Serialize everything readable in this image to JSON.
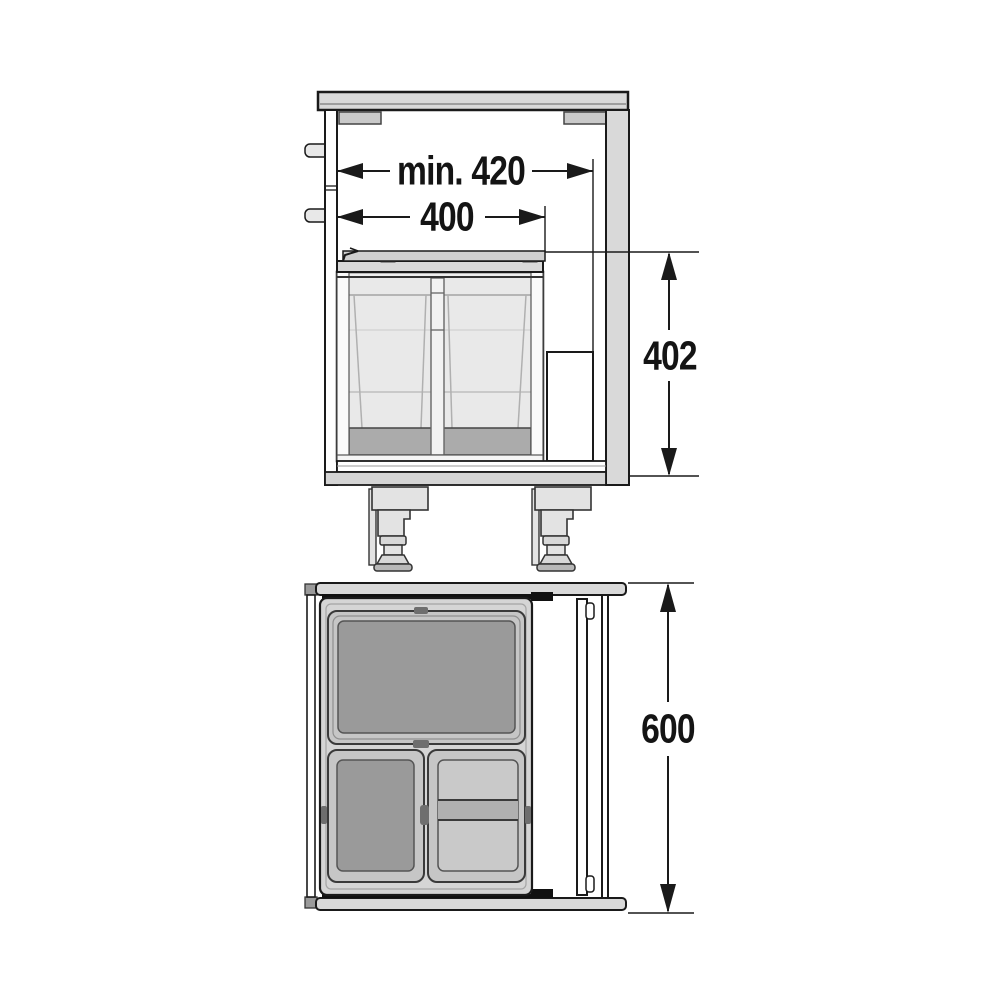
{
  "page": {
    "background": "#ffffff"
  },
  "diagram": {
    "title": "Built-in waste bin cabinet installation drawing",
    "views": [
      {
        "id": "side-view",
        "name": "cabinet cross-section side view"
      },
      {
        "id": "top-view",
        "name": "cabinet plan top view"
      }
    ],
    "dimensions": [
      {
        "id": "min-interior-depth",
        "label": "min. 420",
        "view": "side-view",
        "orientation": "horizontal"
      },
      {
        "id": "bin-unit-width",
        "label": "400",
        "view": "side-view",
        "orientation": "horizontal"
      },
      {
        "id": "bin-unit-height",
        "label": "402",
        "view": "side-view",
        "orientation": "vertical"
      },
      {
        "id": "cabinet-depth",
        "label": "600",
        "view": "top-view",
        "orientation": "vertical"
      }
    ],
    "colors": {
      "line": "#1a1a1a",
      "panel_light": "#d9d9d9",
      "lid_dark": "#9a9a9a",
      "lid_light": "#c9c9c9",
      "tray": "#d5d5d5",
      "black_seal": "#111111",
      "background": "#ffffff"
    }
  }
}
